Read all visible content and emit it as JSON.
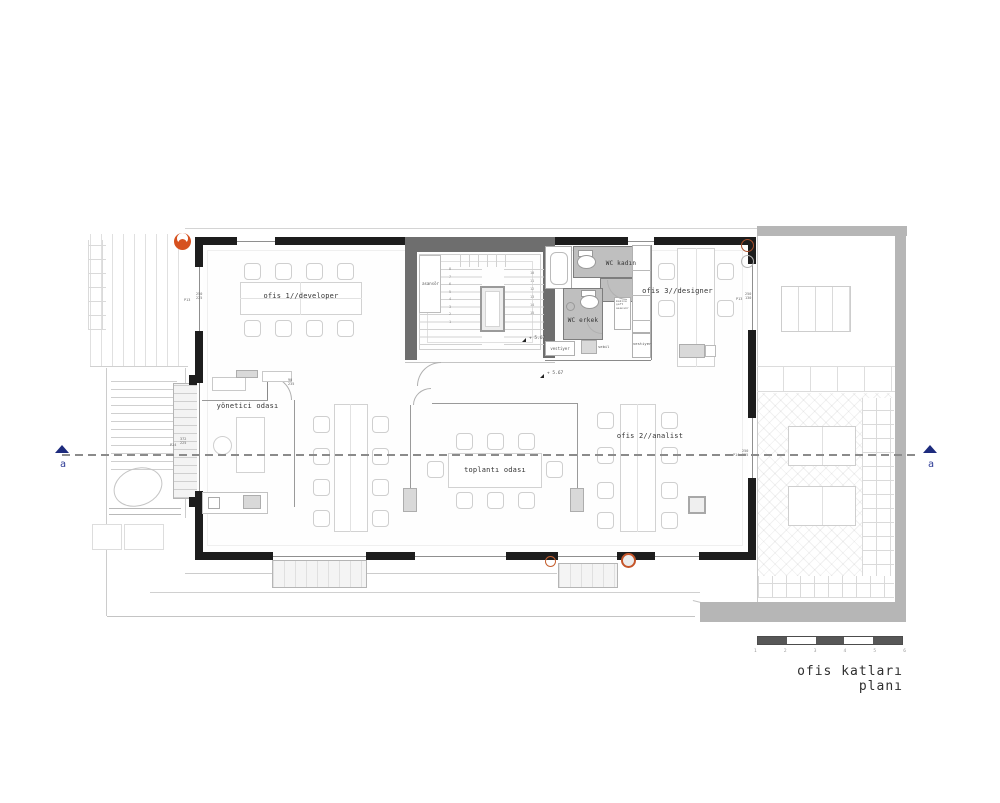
{
  "title": "ofis katları planı",
  "section": {
    "label_left": "a",
    "label_right": "a"
  },
  "rooms": {
    "ofis1": {
      "label": "ofis 1//developer"
    },
    "ofis2": {
      "label": "ofis 2//analist"
    },
    "ofis3": {
      "label": "ofis 3//designer"
    },
    "yonetici": {
      "label": "yönetici odası"
    },
    "toplanti": {
      "label": "toplantı odası"
    },
    "wc_kadin": {
      "label": "WC kadın"
    },
    "wc_erkek": {
      "label": "WC erkek"
    },
    "asansor": {
      "label": "asansör"
    },
    "vestiyer_a": {
      "label": "vestiyer"
    },
    "vestiyer_b": {
      "label": "vestiyer"
    },
    "sebil": {
      "label": "sebil"
    }
  },
  "ann": {
    "level_a": "+ 5.67",
    "level_b": "+ 5.67",
    "door_dim": "90\n235",
    "p_left1": "P13",
    "d_left1": "250\n225",
    "p_left2": "P14",
    "d_left2": "372\n225",
    "p_right1": "P13",
    "d_right1": "250\n130",
    "p_right2": "P14",
    "d_right2": "250\n225",
    "shaft": "makine\nşaft\nasansör",
    "stair_steps_left": [
      "8",
      "7",
      "6",
      "5",
      "4",
      "3",
      "2",
      "1"
    ],
    "stair_steps_right": [
      "10",
      "11",
      "12",
      "13",
      "14",
      "15"
    ]
  },
  "scalebar": {
    "ticks": [
      "1",
      "2",
      "3",
      "4",
      "5",
      "6"
    ]
  },
  "colors": {
    "wall": "#1d1d1d",
    "core_wall": "#6e6e6e",
    "wc_floor": "#bfbfbf",
    "accent_orange": "#d6511f",
    "section_blue": "#1d2b7d",
    "shadow_gray": "#b6b6b6"
  }
}
